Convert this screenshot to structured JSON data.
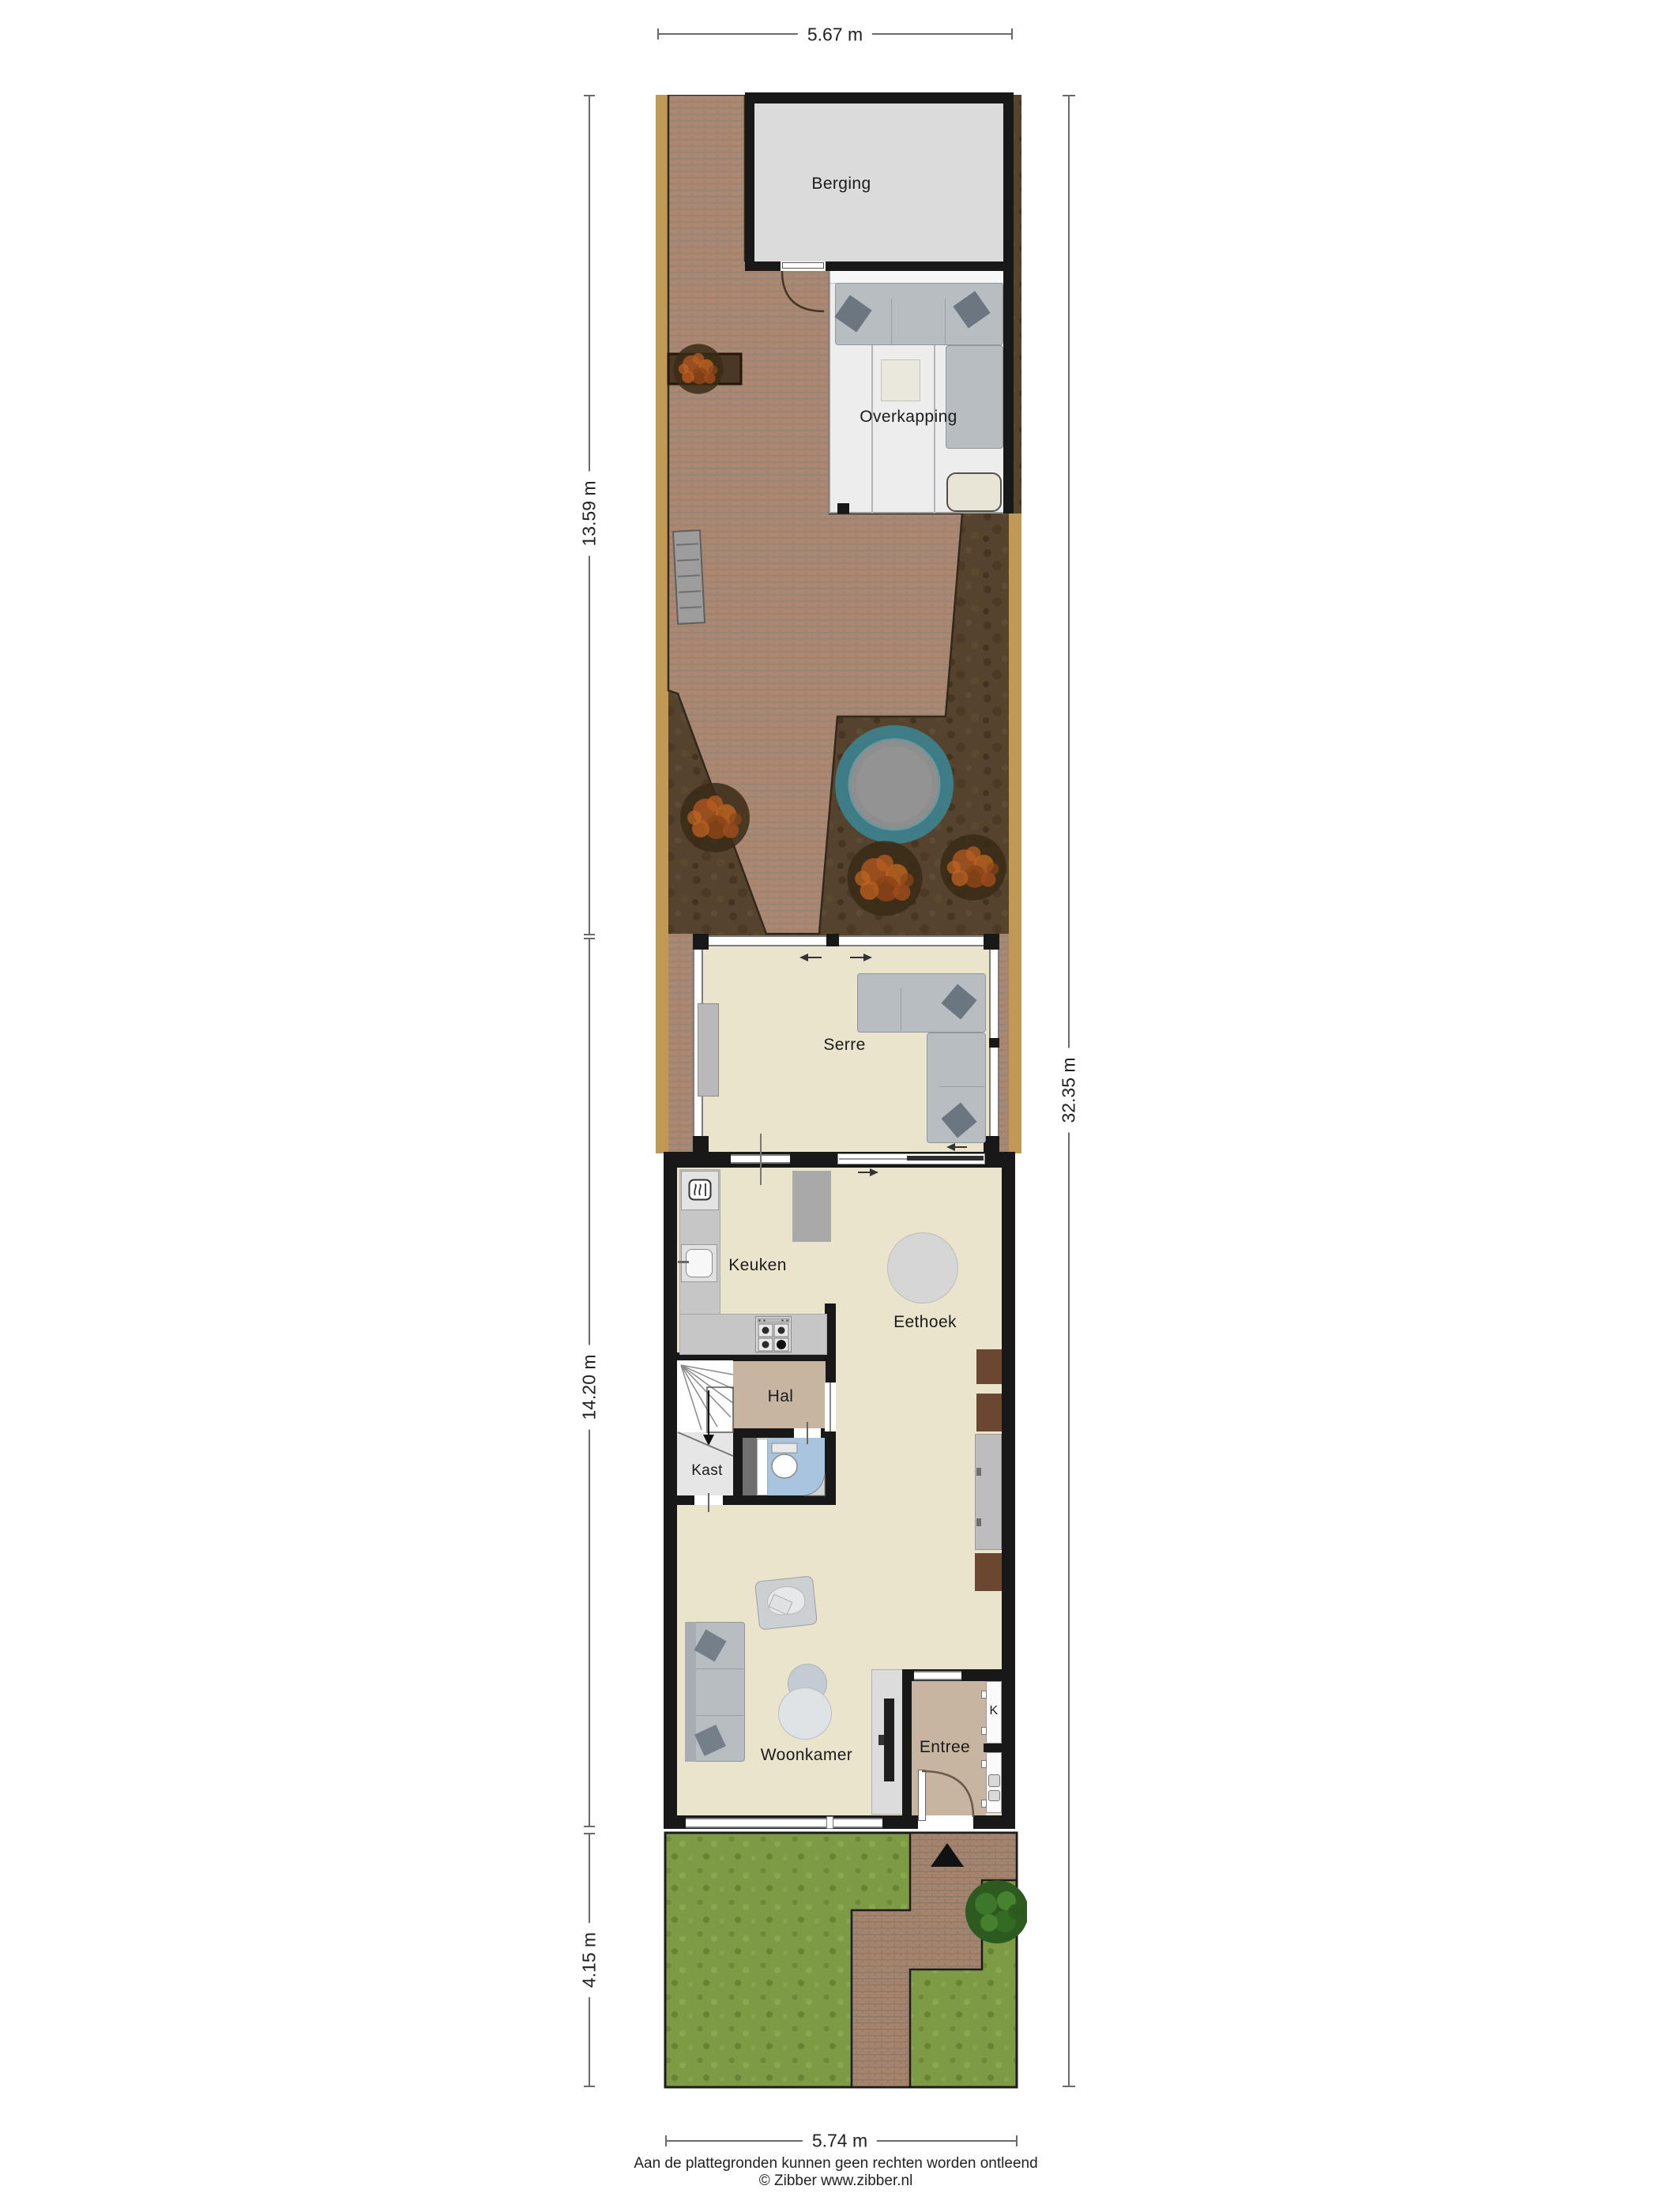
{
  "dimensions": {
    "top": "5.67 m",
    "garden_left": "13.59 m",
    "house_left": "14.20 m",
    "front_left": "4.15 m",
    "total_right": "32.35 m",
    "bottom": "5.74 m"
  },
  "rooms": {
    "berging": "Berging",
    "overkapping": "Overkapping",
    "serre": "Serre",
    "keuken": "Keuken",
    "eethoek": "Eethoek",
    "hal": "Hal",
    "kast": "Kast",
    "entree": "Entree",
    "woonkamer": "Woonkamer",
    "closet_k": "K"
  },
  "footer": {
    "disclaimer": "Aan de plattegronden kunnen geen rechten worden ontleend",
    "credit": "© Zibber www.zibber.nl"
  },
  "colors": {
    "wall": "#181818",
    "floor_main": "#ebe4cd",
    "floor_hal": "#c7b5a1",
    "floor_kast": "#e6e6e6",
    "floor_toilet": "#a9c4df",
    "floor_berging": "#dbdbdb",
    "floor_overkapping": "#ededed",
    "brick": "#b1856b",
    "dirt": "#55432d",
    "sand_border": "#c09a55",
    "grass": "#7d9a44",
    "trampoline": "#3e7d85",
    "shrub_orange": "#b05a26",
    "bush_green": "#3f7a2a",
    "sofa_gray": "#b7bdc1",
    "cabinet_brown": "#6b4731"
  }
}
